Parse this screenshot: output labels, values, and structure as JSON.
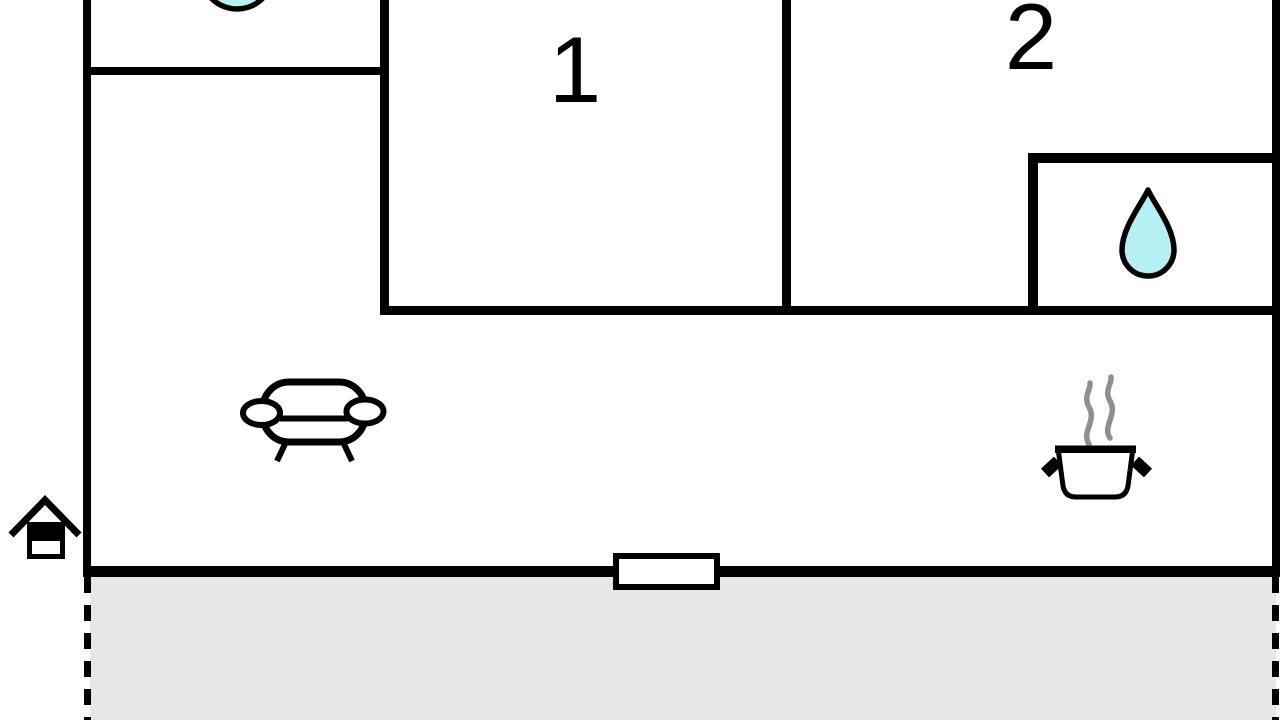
{
  "canvas": {
    "width": 1280,
    "height": 720,
    "background": "#ffffff"
  },
  "colors": {
    "wall": "#000000",
    "water": "#b5f1f2",
    "terrace": "#e7e7ea",
    "steam": "#8f8f8f"
  },
  "rooms": {
    "room1": {
      "label": "1"
    },
    "room2": {
      "label": "2"
    }
  },
  "icons": {
    "washbasin": "washbasin-icon",
    "water_drop": "water-drop-icon",
    "sofa": "sofa-icon",
    "cooking_pot": "cooking-pot-icon",
    "steam": "steam-icon",
    "entrance_house": "entrance-house-icon",
    "door": "door-icon"
  }
}
